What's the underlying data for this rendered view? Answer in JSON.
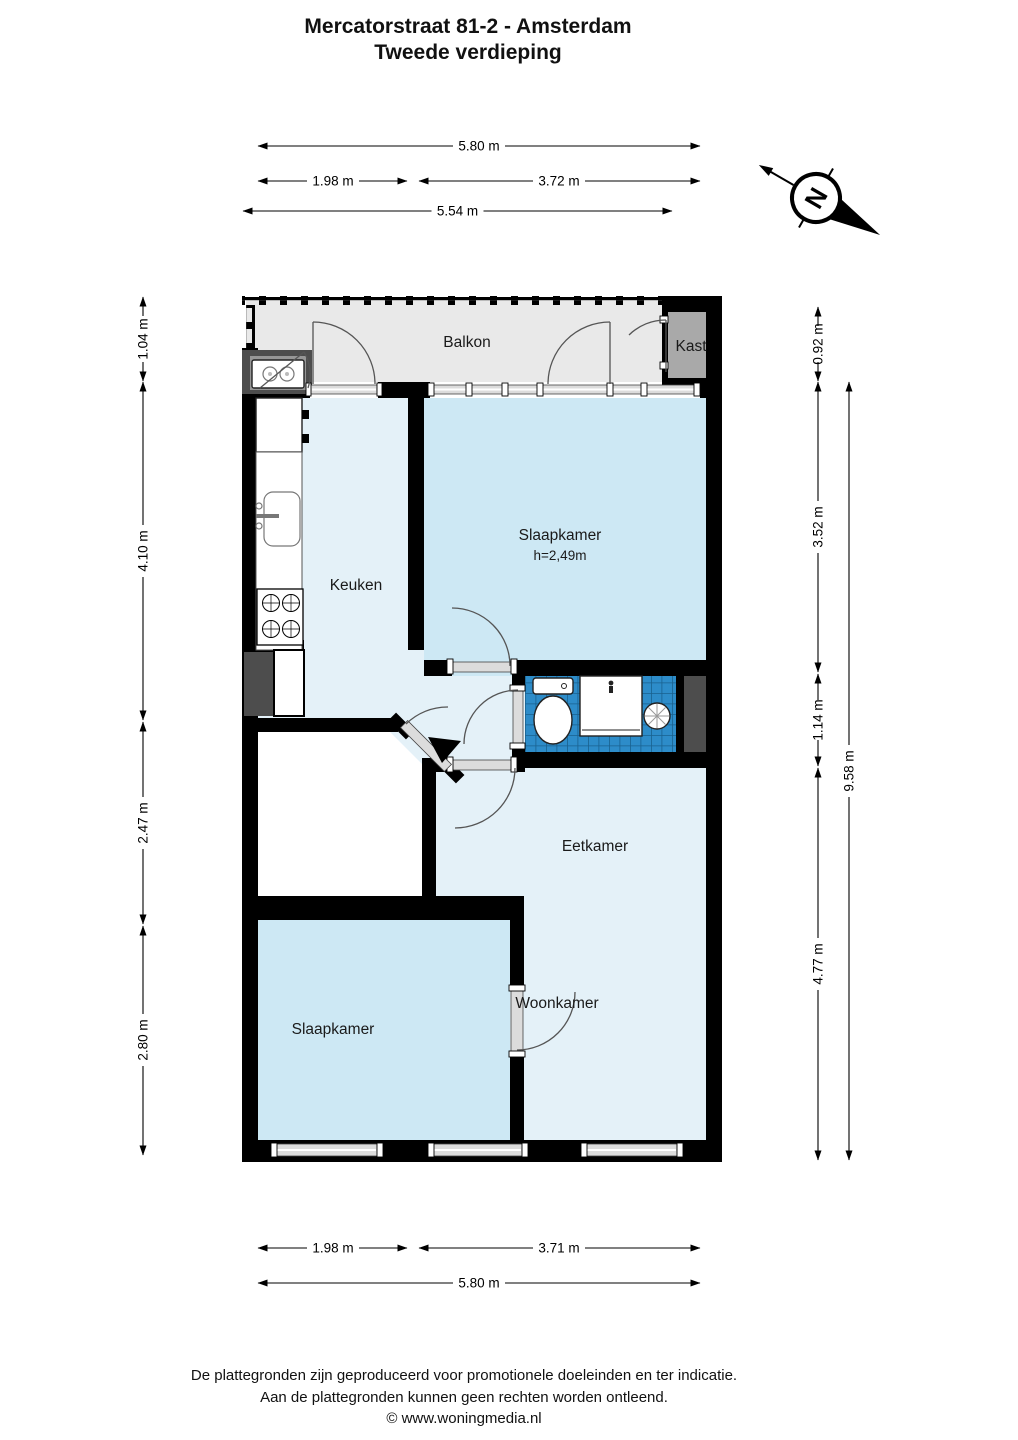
{
  "title": {
    "line1": "Mercatorstraat 81-2 - Amsterdam",
    "line2": "Tweede verdieping"
  },
  "compass": {
    "north_label": "N"
  },
  "rooms": {
    "balkon": "Balkon",
    "kast": "Kast",
    "keuken": "Keuken",
    "slaapkamer_top": "Slaapkamer",
    "slaapkamer_top_height": "h=2,49m",
    "eetkamer": "Eetkamer",
    "woonkamer": "Woonkamer",
    "slaapkamer_bottom": "Slaapkamer"
  },
  "dimensions": {
    "top": [
      "5.80 m",
      "1.98 m",
      "3.72 m",
      "5.54 m"
    ],
    "bottom": [
      "1.98 m",
      "3.71 m",
      "5.80 m"
    ],
    "left": [
      "1.04 m",
      "4.10 m",
      "2.47 m",
      "2.80 m"
    ],
    "right": [
      "0.92 m",
      "3.52 m",
      "1.14 m",
      "4.77 m",
      "9.58 m"
    ]
  },
  "footer": {
    "line1": "De plattegronden zijn geproduceerd voor promotionele doeleinden en ter indicatie.",
    "line2": "Aan de plattegronden kunnen geen rechten worden ontleend.",
    "line3": "© www.woningmedia.nl"
  },
  "colors": {
    "wall": "#000000",
    "floor_light": "#e4f1f8",
    "floor_medium": "#cde8f4",
    "balcony": "#e9e9e9",
    "closet": "#a9a9a9",
    "bathroom_tiles": "#2d8cc9",
    "shaft": "#4d4d4d"
  }
}
